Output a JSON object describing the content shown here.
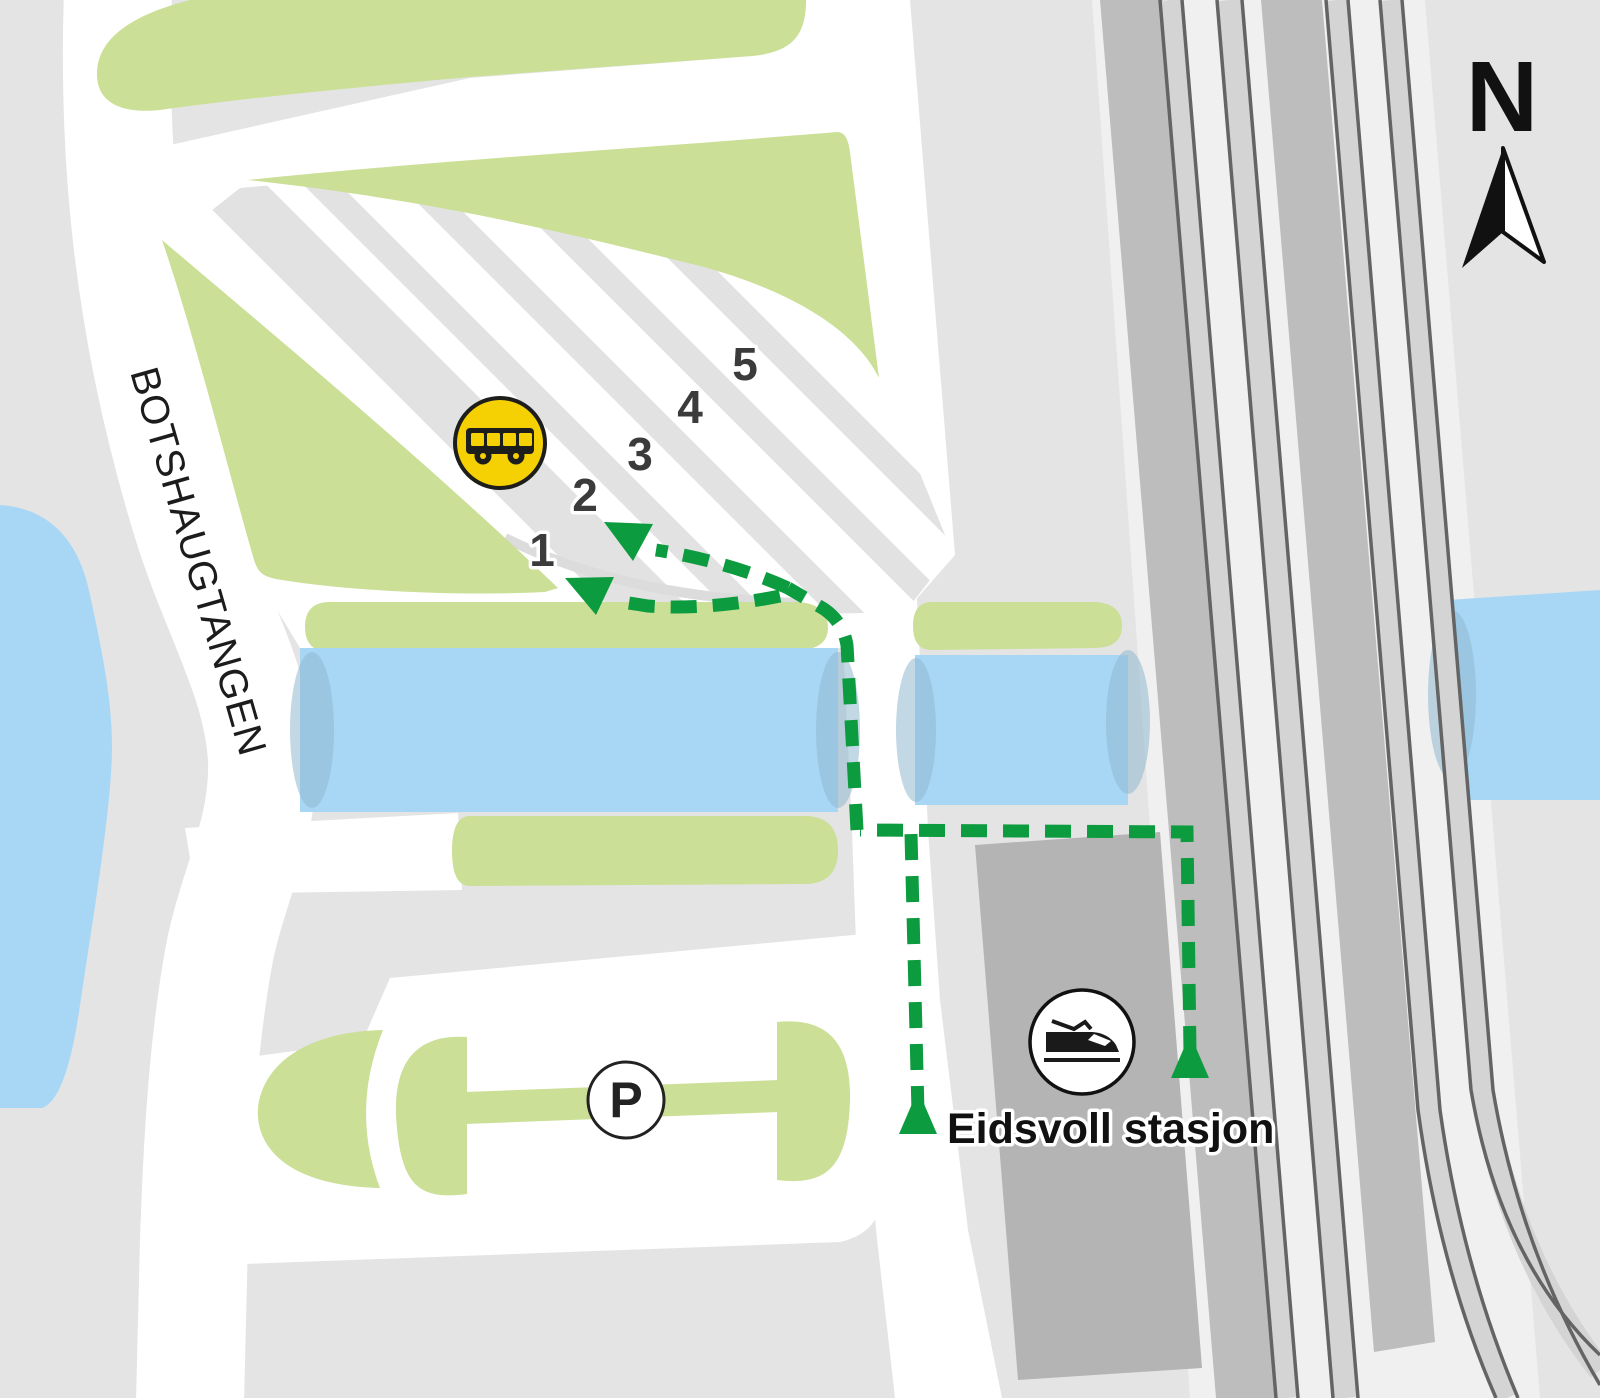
{
  "map": {
    "title_area": "Eidsvoll station area map",
    "street_label": "BOTSHAUGTANGEN",
    "station_label": "Eidsvoll stasjon",
    "parking_label": "P",
    "compass_label": "N",
    "bays": [
      "1",
      "2",
      "3",
      "4",
      "5"
    ],
    "icons": {
      "bus": "bus-icon",
      "train": "train-icon",
      "parking": "parking-icon",
      "north_arrow": "north-arrow-icon",
      "route_start_marker": "route-start-triangle",
      "route_arrow": "route-direction-arrow"
    },
    "colors": {
      "background_gray": "#e4e4e4",
      "road_white": "#ffffff",
      "green_area": "#cbdf96",
      "water_blue": "#a8d7f5",
      "water_shadow": "#8fb8d0",
      "route_green": "#0d9b3f",
      "bus_yellow": "#f5d002",
      "station_building_gray": "#b4b4b4",
      "platform_gray": "#bdbdbd",
      "rail_dark": "#646464",
      "stripe_gray": "#e2e2e2",
      "text_dark": "#1c1c1c",
      "number_gray": "#3b3b3b"
    }
  }
}
